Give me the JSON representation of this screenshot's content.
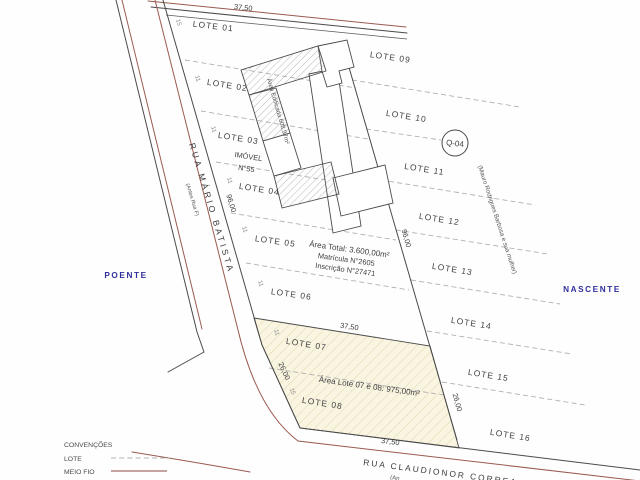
{
  "compass": {
    "west": "POENTE",
    "east": "NASCENTE"
  },
  "streets": {
    "main": {
      "name": "RUA MÁRIO BATISTA",
      "former_name": "(Antes Rua F)"
    },
    "cross": {
      "name": "RUA CLAUDIONOR CORREA",
      "former_name": "(An"
    }
  },
  "quadra_badge": "Q-04",
  "neighbor_note": "(Mauro Rodrigues Barbosa e sua mulher)",
  "property": {
    "imovel": "IMÓVEL",
    "imovel_number": "N°55",
    "area_total": "Área Total: 3.600,00m²",
    "matricula": "Matrícula N°2605",
    "inscricao": "Inscrição N°27471",
    "area_edificada": "Área Edificada 608,97m²",
    "area_lots_07_08": "Área Lote 07 e 08: 975,00m²"
  },
  "lots": [
    "LOTE 01",
    "LOTE 02",
    "LOTE 03",
    "LOTE 04",
    "LOTE 05",
    "LOTE 06",
    "LOTE 07",
    "LOTE 08",
    "LOTE 09",
    "LOTE 10",
    "LOTE 11",
    "LOTE 12",
    "LOTE 13",
    "LOTE 14",
    "LOTE 15",
    "LOTE 16"
  ],
  "dimensions": {
    "frontage_total": "37,50",
    "depth": "96,00",
    "depth_07_08": "26,00",
    "lot_frontage": "11",
    "corner_frontage": "15"
  },
  "legend": {
    "title": "CONVENÇÕES",
    "items": [
      {
        "label": "LOTE"
      },
      {
        "label": "MEIO FIO"
      }
    ]
  },
  "colors": {
    "curb_red": "#9a5a50",
    "legend_red": "#8a4a42",
    "compass_blue": "#2e2e9e",
    "lot_highlight_fill": "#faf5e1",
    "line_gray": "#4a4a4a"
  }
}
